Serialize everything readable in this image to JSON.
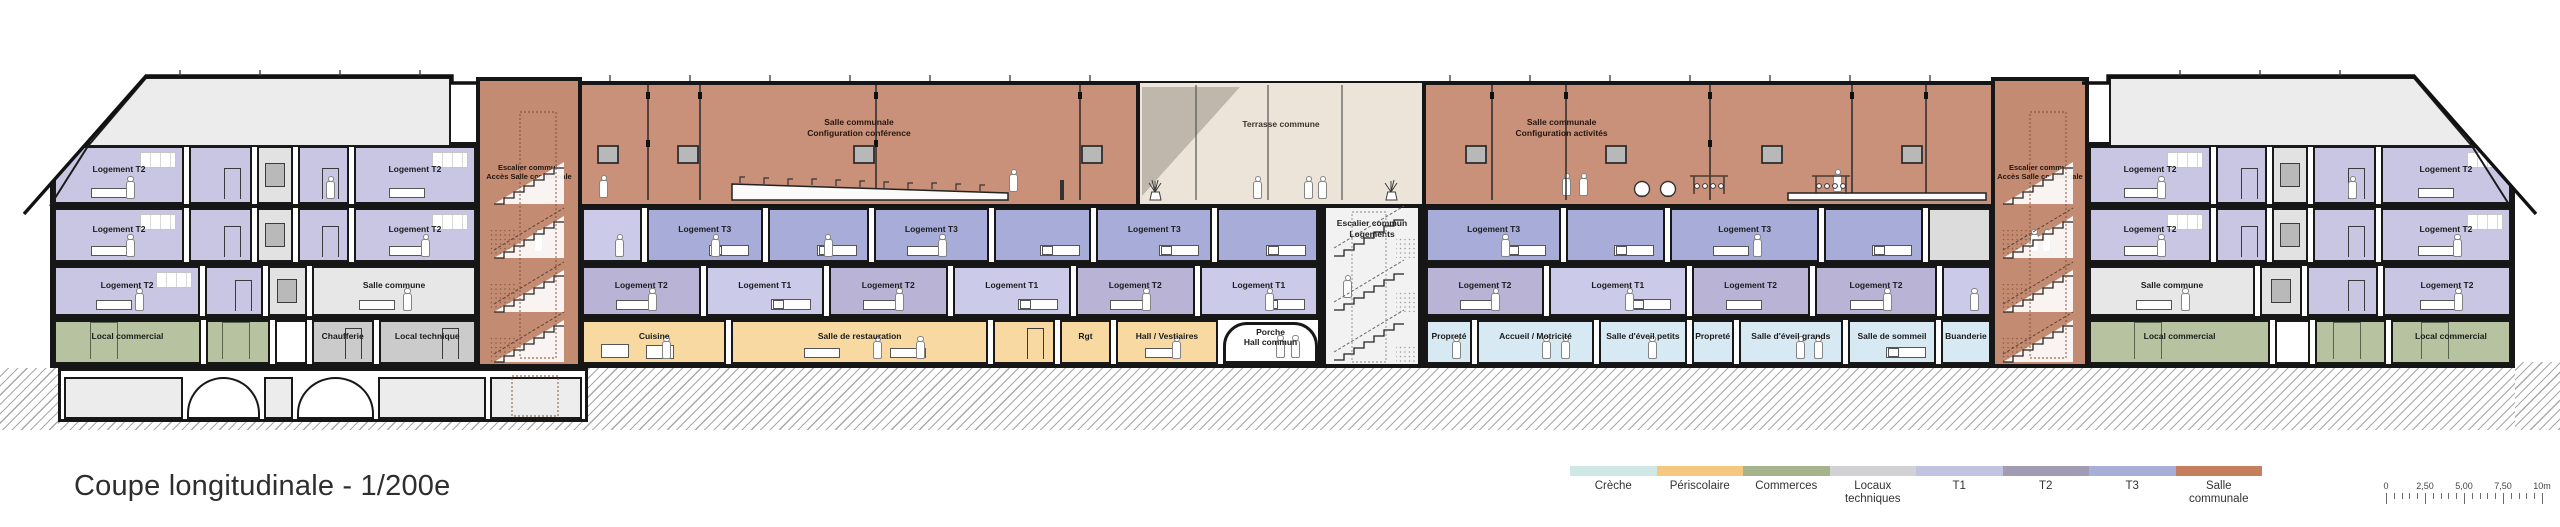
{
  "title": "Coupe longitudinale - 1/200e",
  "legend": {
    "items": [
      {
        "label": "Crèche",
        "color": "#cfe8e6"
      },
      {
        "label": "Périscolaire",
        "color": "#f6c87f"
      },
      {
        "label": "Commerces",
        "color": "#a6b48b"
      },
      {
        "label": "Locaux\ntechniques",
        "color": "#d2d2d4"
      },
      {
        "label": "T1",
        "color": "#c2c2e1"
      },
      {
        "label": "T2",
        "color": "#a19bb3"
      },
      {
        "label": "T3",
        "color": "#a7aed7"
      },
      {
        "label": "Salle\ncommunale",
        "color": "#c67f5e"
      }
    ]
  },
  "scalebar": {
    "labels": [
      "0",
      "2,50",
      "5,00",
      "7,50",
      "10m"
    ]
  },
  "colors": {
    "t1": "#cbcbe9",
    "t2": "#b9b3d5",
    "t2w": "#c9c6e4",
    "t3": "#a7add8",
    "salleco": "#e7e7e7",
    "grayr": "#dcdcdc",
    "shaft": "#e2e2e2",
    "comm": "#b6c2a0",
    "tech": "#cbcbcb",
    "peri": "#f8d9a2",
    "cre": "#d7e9f3",
    "porte": "#ffffff",
    "porche": "#ffffff",
    "cave": "#ececec",
    "vault": "#ffffff",
    "cavern": "#ececec",
    "cavedot": "#ededed",
    "salle_wall": "#c9917a",
    "stair": "#c38c72",
    "terrasse": "#ece4d8",
    "attic": "#ececec"
  },
  "building": {
    "salle_left": {
      "label": "Salle communale\nConfiguration conférence"
    },
    "salle_right": {
      "label": "Salle communale\nConfiguration activités"
    },
    "terrasse": {
      "label": "Terrasse commune"
    },
    "stair_left": {
      "label": "Escalier commun\nAccès Salle communale"
    },
    "stair_right": {
      "label": "Escalier commun\nAccès Salle communale"
    },
    "stair_center": {
      "label": "Escalier commun\nLogements"
    },
    "strips": [
      {
        "id": "lw_attic",
        "rooms": [
          {
            "type": "t2w",
            "label": "Logement T2",
            "w": 3.2,
            "f": [
              "window",
              "table",
              "person"
            ]
          },
          {
            "type": "t2w",
            "label": "",
            "w": 1.5,
            "f": [
              "door"
            ]
          },
          {
            "type": "shaft",
            "label": "",
            "w": 0.8,
            "f": [
              "lift"
            ]
          },
          {
            "type": "t2w",
            "label": "",
            "w": 1.2,
            "f": [
              "door",
              "person"
            ]
          },
          {
            "type": "t2w",
            "label": "Logement T2",
            "w": 3.0,
            "f": [
              "window",
              "table"
            ]
          }
        ]
      },
      {
        "id": "lw_f3",
        "rooms": [
          {
            "type": "t2w",
            "label": "Logement T2",
            "w": 3.2,
            "f": [
              "window",
              "table",
              "person"
            ]
          },
          {
            "type": "t2w",
            "label": "",
            "w": 1.5,
            "f": [
              "door"
            ]
          },
          {
            "type": "shaft",
            "label": "",
            "w": 0.8,
            "f": [
              "lift"
            ]
          },
          {
            "type": "t2w",
            "label": "",
            "w": 1.2,
            "f": [
              "door"
            ]
          },
          {
            "type": "t2w",
            "label": "Logement T2",
            "w": 3.0,
            "f": [
              "window",
              "table",
              "person"
            ]
          }
        ]
      },
      {
        "id": "lw_f2",
        "rooms": [
          {
            "type": "t2w",
            "label": "Logement T2",
            "w": 3.2,
            "f": [
              "window",
              "table",
              "person"
            ]
          },
          {
            "type": "t2w",
            "label": "",
            "w": 1.2,
            "f": [
              "door"
            ]
          },
          {
            "type": "shaft",
            "label": "",
            "w": 0.8,
            "f": [
              "lift"
            ]
          },
          {
            "type": "salleco",
            "label": "Salle commune",
            "w": 3.6,
            "f": [
              "table",
              "person"
            ]
          }
        ]
      },
      {
        "id": "lw_gr",
        "rooms": [
          {
            "type": "comm",
            "label": "Local commercial",
            "w": 2.6,
            "f": [
              "doorg"
            ]
          },
          {
            "type": "comm",
            "label": "",
            "w": 1.1,
            "f": [
              "doorg"
            ]
          },
          {
            "type": "porte",
            "label": "",
            "w": 0.5,
            "f": []
          },
          {
            "type": "tech",
            "label": "Chaufferie",
            "w": 1.05,
            "f": [
              "door"
            ]
          },
          {
            "type": "tech",
            "label": "Local technique",
            "w": 1.7,
            "f": [
              "door"
            ]
          }
        ]
      },
      {
        "id": "lw_base",
        "rooms": [
          {
            "type": "cave",
            "label": "",
            "w": 1.5,
            "f": []
          },
          {
            "type": "vault",
            "label": "",
            "w": 0.9,
            "f": []
          },
          {
            "type": "cavern",
            "label": "",
            "w": 0.33,
            "f": []
          },
          {
            "type": "vault",
            "label": "",
            "w": 0.95,
            "f": []
          },
          {
            "type": "cave",
            "label": "",
            "w": 1.35,
            "f": []
          },
          {
            "type": "cavedot",
            "label": "",
            "w": 1.15,
            "f": []
          }
        ]
      },
      {
        "id": "c_f3_l",
        "rooms": [
          {
            "type": "t1",
            "label": "",
            "w": 0.75,
            "f": [
              "person"
            ]
          },
          {
            "type": "t3",
            "label": "Logement T3",
            "w": 1.5,
            "f": [
              "bed",
              "person"
            ]
          },
          {
            "type": "t3",
            "label": "",
            "w": 1.3,
            "f": [
              "bed",
              "person"
            ]
          },
          {
            "type": "t3",
            "label": "Logement T3",
            "w": 1.5,
            "f": [
              "table",
              "person"
            ]
          },
          {
            "type": "t3",
            "label": "",
            "w": 1.25,
            "f": [
              "bed"
            ]
          },
          {
            "type": "t3",
            "label": "Logement T3",
            "w": 1.5,
            "f": [
              "bed"
            ]
          },
          {
            "type": "t3",
            "label": "",
            "w": 1.3,
            "f": [
              "bed"
            ]
          }
        ]
      },
      {
        "id": "c_f3_r",
        "rooms": [
          {
            "type": "t3",
            "label": "Logement T3",
            "w": 1.45,
            "f": [
              "bed",
              "person"
            ]
          },
          {
            "type": "t3",
            "label": "",
            "w": 1.05,
            "f": [
              "bed"
            ]
          },
          {
            "type": "t3",
            "label": "Logement T3",
            "w": 1.6,
            "f": [
              "table",
              "person"
            ]
          },
          {
            "type": "t3",
            "label": "",
            "w": 1.05,
            "f": [
              "bed"
            ]
          },
          {
            "type": "grayr",
            "label": "",
            "w": 0.65,
            "f": []
          }
        ]
      },
      {
        "id": "c_f2_l",
        "rooms": [
          {
            "type": "t2",
            "label": "Logement T2",
            "w": 1,
            "f": [
              "table",
              "person"
            ]
          },
          {
            "type": "t1",
            "label": "Logement T1",
            "w": 1,
            "f": [
              "bed"
            ]
          },
          {
            "type": "t2",
            "label": "Logement T2",
            "w": 1,
            "f": [
              "table",
              "person"
            ]
          },
          {
            "type": "t1",
            "label": "Logement T1",
            "w": 1,
            "f": [
              "bed"
            ]
          },
          {
            "type": "t2",
            "label": "Logement T2",
            "w": 1,
            "f": [
              "table",
              "person"
            ]
          },
          {
            "type": "t1",
            "label": "Logement T1",
            "w": 1,
            "f": [
              "bed",
              "person"
            ]
          }
        ]
      },
      {
        "id": "c_f2_r",
        "rooms": [
          {
            "type": "t2",
            "label": "Logement T2",
            "w": 1.15,
            "f": [
              "table",
              "person"
            ]
          },
          {
            "type": "t1",
            "label": "Logement T1",
            "w": 1.35,
            "f": [
              "bed",
              "person"
            ]
          },
          {
            "type": "t2",
            "label": "Logement T2",
            "w": 1.15,
            "f": [
              "table"
            ]
          },
          {
            "type": "t2",
            "label": "Logement T2",
            "w": 1.2,
            "f": [
              "table",
              "person"
            ]
          },
          {
            "type": "t1",
            "label": "",
            "w": 0.45,
            "f": [
              "person"
            ]
          }
        ]
      },
      {
        "id": "c_gr_l",
        "rooms": [
          {
            "type": "peri",
            "label": "Cuisine",
            "w": 1.5,
            "f": [
              "counter",
              "person"
            ]
          },
          {
            "type": "peri",
            "label": "Salle de restauration",
            "w": 2.7,
            "f": [
              "table",
              "table2",
              "person",
              "person2"
            ]
          },
          {
            "type": "peri",
            "label": "",
            "w": 0.62,
            "f": [
              "door"
            ]
          },
          {
            "type": "peri",
            "label": "Rgt",
            "w": 0.5,
            "f": []
          },
          {
            "type": "peri",
            "label": "Hall / Vestiaires",
            "w": 1.05,
            "f": [
              "table",
              "person"
            ]
          },
          {
            "type": "porche",
            "label": "Porche\nHall commun",
            "w": 0.95,
            "f": [
              "person",
              "person2"
            ]
          }
        ]
      },
      {
        "id": "c_gr_r",
        "rooms": [
          {
            "type": "cre",
            "label": "Propreté",
            "w": 0.5,
            "f": [
              "person"
            ]
          },
          {
            "type": "cre",
            "label": "Accueil / Motricité",
            "w": 1.35,
            "f": [
              "person",
              "person2"
            ]
          },
          {
            "type": "cre",
            "label": "Salle d'éveil petits",
            "w": 1.0,
            "f": [
              "person"
            ]
          },
          {
            "type": "cre",
            "label": "Propreté",
            "w": 0.45,
            "f": []
          },
          {
            "type": "cre",
            "label": "Salle d'éveil grands",
            "w": 1.2,
            "f": [
              "person",
              "person2"
            ]
          },
          {
            "type": "cre",
            "label": "Salle de sommeil",
            "w": 1.0,
            "f": [
              "bed"
            ]
          },
          {
            "type": "cre",
            "label": "Buanderie",
            "w": 0.55,
            "f": []
          }
        ]
      },
      {
        "id": "rw_attic",
        "rooms": [
          {
            "type": "t2w",
            "label": "Logement T2",
            "w": 3.0,
            "f": [
              "window",
              "table",
              "person"
            ]
          },
          {
            "type": "t2w",
            "label": "",
            "w": 1.2,
            "f": [
              "door"
            ]
          },
          {
            "type": "shaft",
            "label": "",
            "w": 0.8,
            "f": [
              "lift"
            ]
          },
          {
            "type": "t2w",
            "label": "",
            "w": 1.5,
            "f": [
              "door",
              "person"
            ]
          },
          {
            "type": "t2w",
            "label": "Logement T2",
            "w": 3.2,
            "f": [
              "window",
              "table"
            ]
          }
        ]
      },
      {
        "id": "rw_f3",
        "rooms": [
          {
            "type": "t2w",
            "label": "Logement T2",
            "w": 3.0,
            "f": [
              "window",
              "table",
              "person"
            ]
          },
          {
            "type": "t2w",
            "label": "",
            "w": 1.2,
            "f": [
              "door"
            ]
          },
          {
            "type": "shaft",
            "label": "",
            "w": 0.8,
            "f": [
              "lift"
            ]
          },
          {
            "type": "t2w",
            "label": "",
            "w": 1.5,
            "f": [
              "door"
            ]
          },
          {
            "type": "t2w",
            "label": "Logement T2",
            "w": 3.2,
            "f": [
              "window",
              "table",
              "person"
            ]
          }
        ]
      },
      {
        "id": "rw_f2",
        "rooms": [
          {
            "type": "salleco",
            "label": "Salle commune",
            "w": 3.4,
            "f": [
              "table",
              "person"
            ]
          },
          {
            "type": "shaft",
            "label": "",
            "w": 0.8,
            "f": [
              "lift"
            ]
          },
          {
            "type": "t2w",
            "label": "",
            "w": 1.4,
            "f": [
              "door"
            ]
          },
          {
            "type": "t2w",
            "label": "Logement T2",
            "w": 2.6,
            "f": [
              "table",
              "person"
            ]
          }
        ]
      },
      {
        "id": "rw_gr",
        "rooms": [
          {
            "type": "comm",
            "label": "Local commercial",
            "w": 2.9,
            "f": [
              "doorg"
            ]
          },
          {
            "type": "porte",
            "label": "",
            "w": 0.5,
            "f": []
          },
          {
            "type": "comm",
            "label": "",
            "w": 1.1,
            "f": [
              "doorg"
            ]
          },
          {
            "type": "comm",
            "label": "Local commercial",
            "w": 1.9,
            "f": [
              "doorg"
            ]
          }
        ]
      }
    ]
  }
}
